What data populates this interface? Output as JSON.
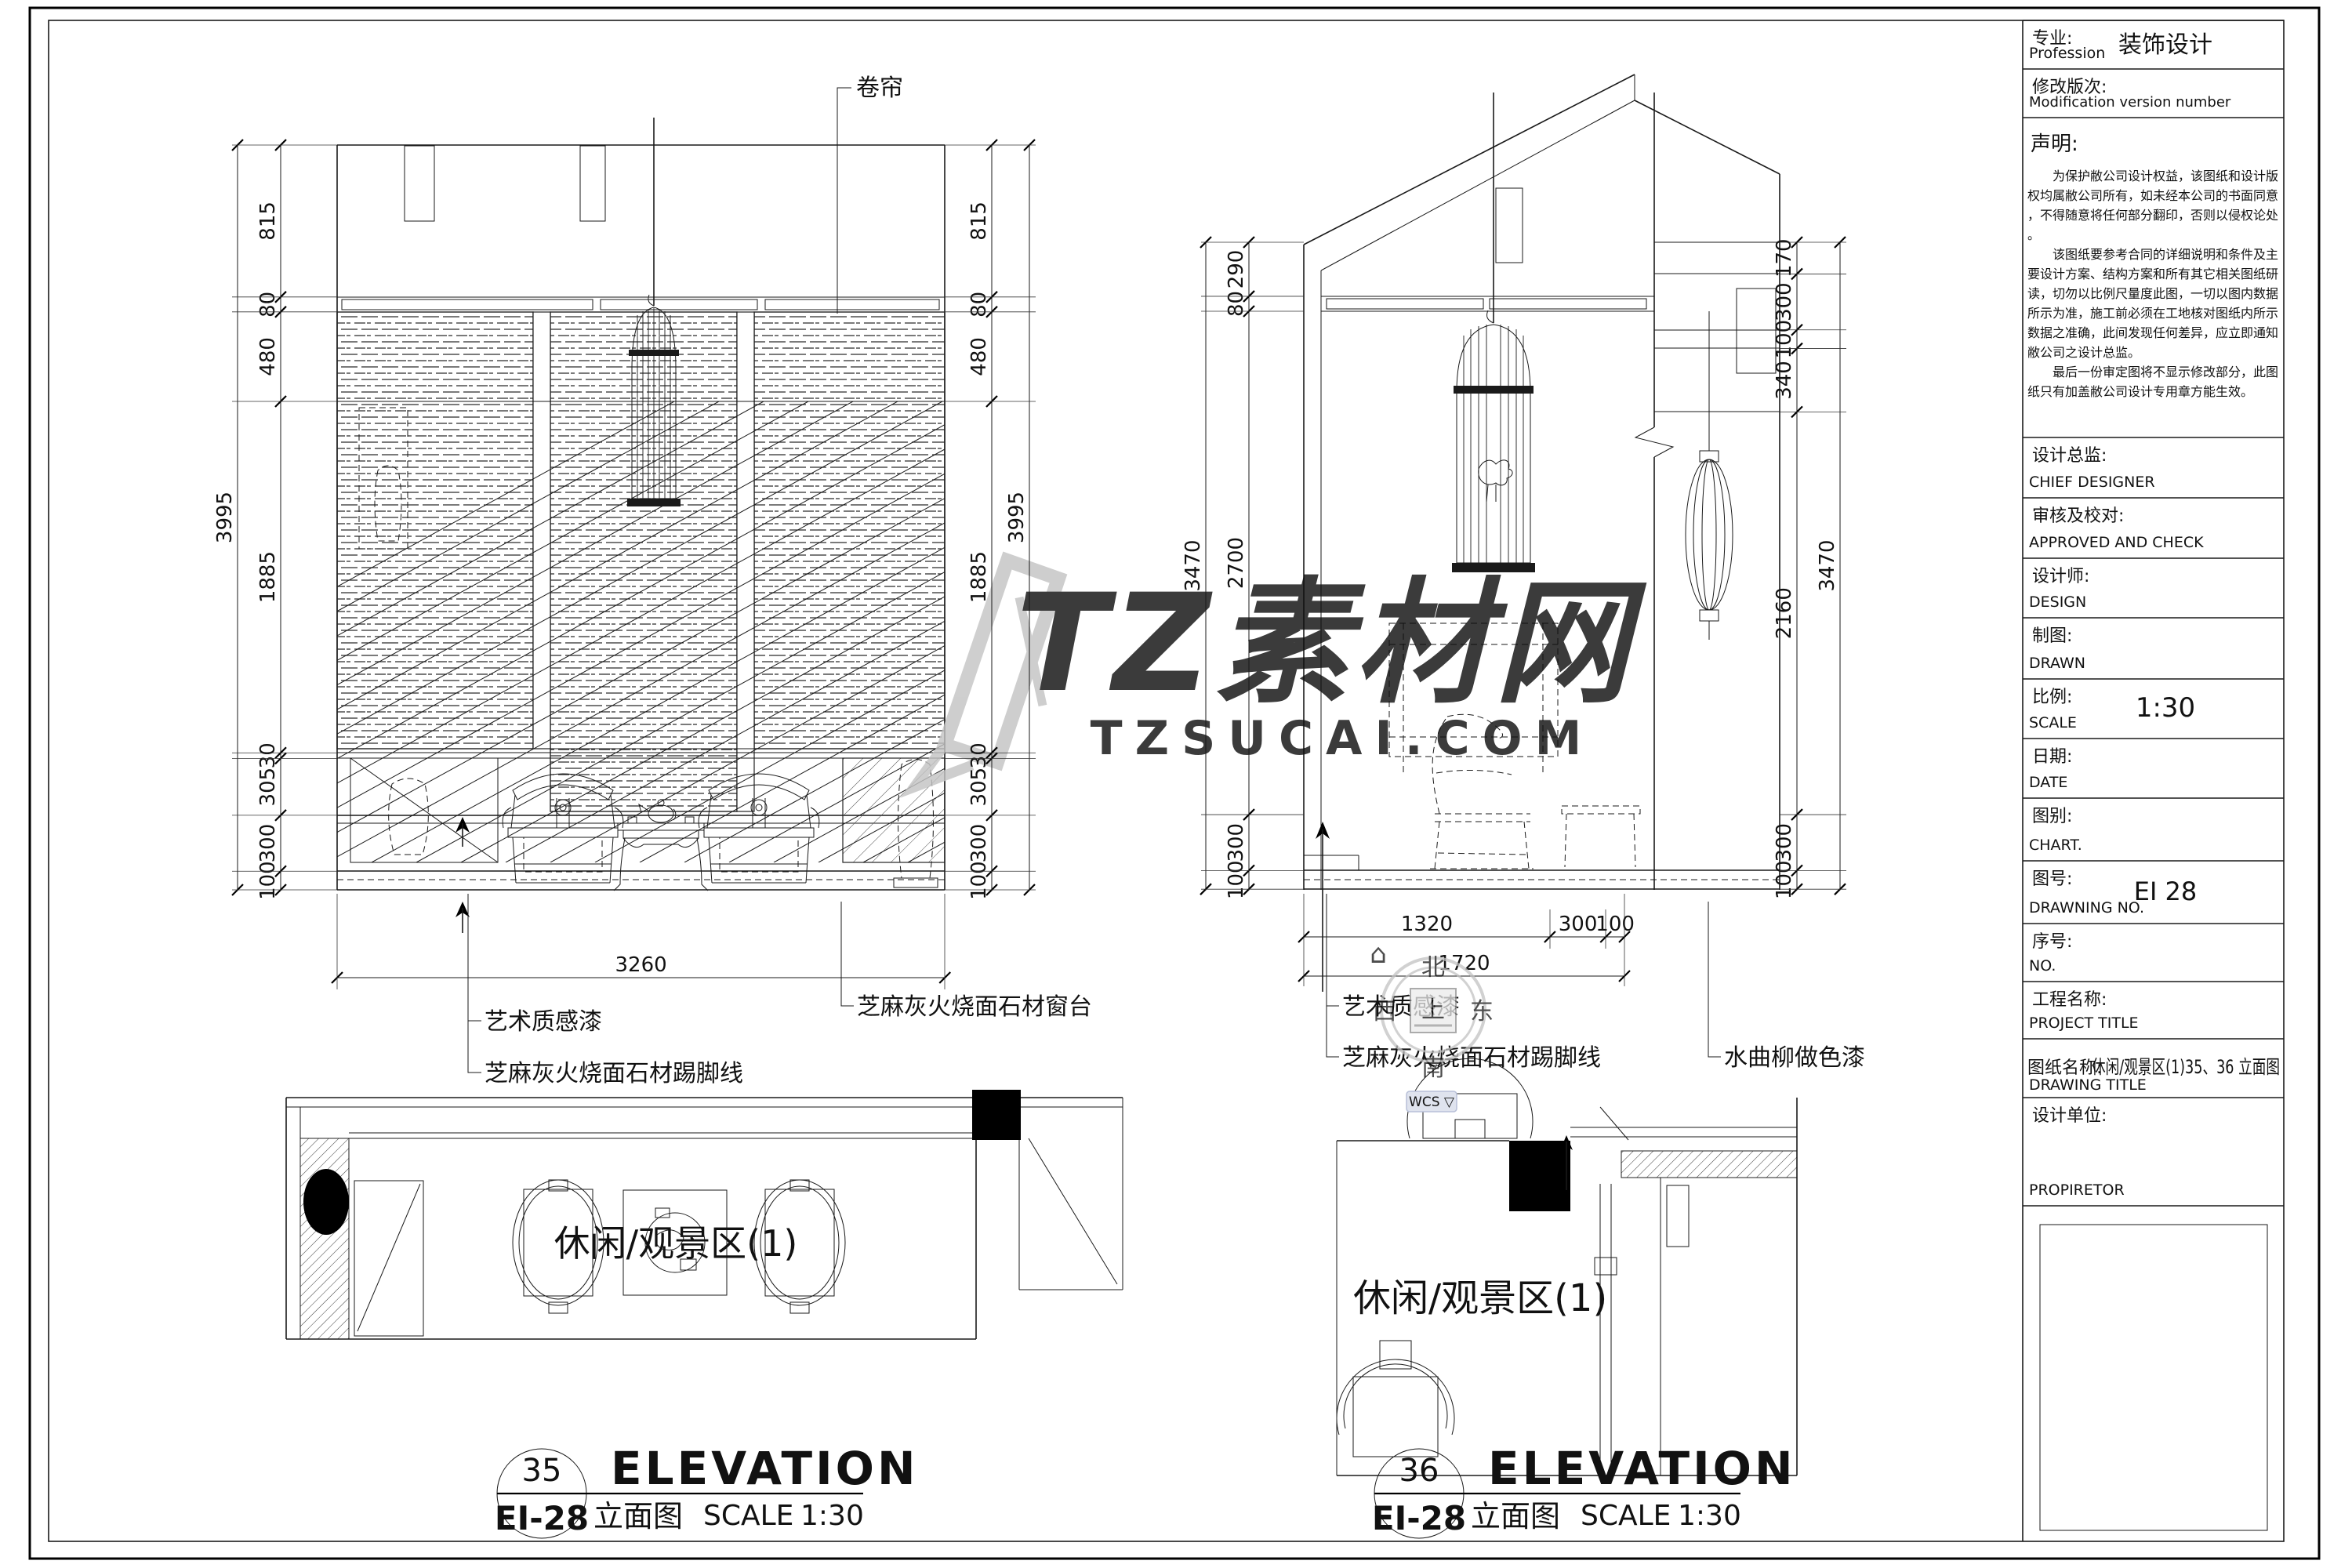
{
  "watermark": {
    "brand": "TZ素材网",
    "domain": "TZSUCAI.COM",
    "color": "#c4c4c4"
  },
  "navigation": {
    "compass": {
      "north": "北",
      "south": "南",
      "east": "东",
      "west": "西",
      "up": "上"
    },
    "home_icon": "⌂",
    "wcs_label": "WCS ▽"
  },
  "elevations": [
    {
      "bubble_no": "35",
      "sheet_no": "EI-28",
      "title_en": "ELEVATION",
      "title_cn": "立面图",
      "scale_label": "SCALE",
      "scale_value": "1:30",
      "labels": {
        "top": "卷帘",
        "finish1": "艺术质感漆",
        "skirting": "芝麻灰火烧面石材踢脚线",
        "sill": "芝麻灰火烧面石材窗台"
      },
      "dims": {
        "left_segments": [
          815,
          80,
          480,
          1885,
          30,
          305,
          300,
          100
        ],
        "left_total": 3995,
        "right_segments": [
          815,
          80,
          480,
          1885,
          30,
          305,
          300,
          100
        ],
        "right_total": 3995,
        "bottom_segments": [
          3260
        ]
      }
    },
    {
      "bubble_no": "36",
      "sheet_no": "EI-28",
      "title_en": "ELEVATION",
      "title_cn": "立面图",
      "scale_label": "SCALE",
      "scale_value": "1:30",
      "labels": {
        "finish1": "艺术质感漆",
        "skirting": "芝麻灰火烧面石材踢脚线",
        "column": "水曲柳做色漆"
      },
      "dims": {
        "left_segments": [
          290,
          80,
          2700,
          300,
          100
        ],
        "left_total": 3470,
        "right_segments": [
          170,
          300,
          100,
          340,
          2160,
          300,
          100
        ],
        "right_total": 3470,
        "bottom_segments": [
          1320,
          300,
          100
        ],
        "bottom_total": 1720
      }
    }
  ],
  "plans": [
    {
      "room_label": "休闲/观景区(1)"
    },
    {
      "room_label": "休闲/观景区(1)"
    }
  ],
  "title_block": {
    "rows": [
      {
        "cn": "专业:",
        "en": "Profession",
        "value": "装饰设计"
      },
      {
        "cn": "修改版次:",
        "en": "Modification version number",
        "value": ""
      },
      {
        "cn": "设计总监:",
        "en": "CHIEF DESIGNER",
        "value": ""
      },
      {
        "cn": "审核及校对:",
        "en": "APPROVED AND CHECK",
        "value": ""
      },
      {
        "cn": "设计师:",
        "en": "DESIGN",
        "value": ""
      },
      {
        "cn": "制图:",
        "en": "DRAWN",
        "value": ""
      },
      {
        "cn": "比例:",
        "en": "SCALE",
        "value": "1:30"
      },
      {
        "cn": "日期:",
        "en": "DATE",
        "value": ""
      },
      {
        "cn": "图别:",
        "en": "CHART.",
        "value": ""
      },
      {
        "cn": "图号:",
        "en": "DRAWNING NO.",
        "value": "EI 28"
      },
      {
        "cn": "序号:",
        "en": "NO.",
        "value": ""
      },
      {
        "cn": "工程名称:",
        "en": "PROJECT TITLE",
        "value": ""
      },
      {
        "cn": "图纸名称:",
        "en": "DRAWING TITLE",
        "value": "休闲/观景区(1)35、36 立面图"
      },
      {
        "cn": "设计单位:",
        "en": "PROPIRETOR",
        "value": ""
      }
    ],
    "statement": {
      "title": "声明:",
      "paragraphs": [
        "为保护敝公司设计权益，该图纸和设计版权均属敝公司所有，如未经本公司的书面同意，不得随意将任何部分翻印，否则以侵权论处。",
        "该图纸要参考合同的详细说明和条件及主要设计方案、结构方案和所有其它相关图纸研读，切勿以比例尺量度此图，一切以图内数据所示为准，施工前必须在工地核对图纸内所示数据之准确，此间发现任何差异，应立即通知敝公司之设计总监。",
        "最后一份审定图将不显示修改部分，此图纸只有加盖敝公司设计专用章方能生效。"
      ]
    }
  }
}
